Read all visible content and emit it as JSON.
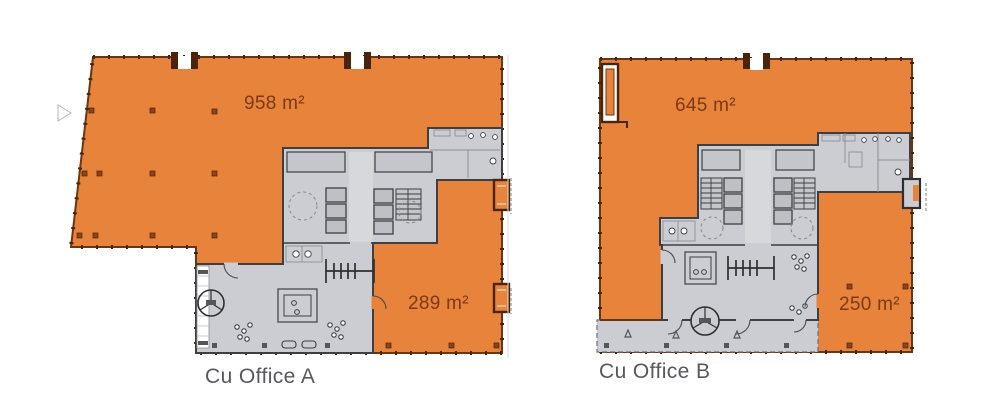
{
  "figure": {
    "type": "floor-plans",
    "description": "Two office floor plans with highlighted leasable areas"
  },
  "colors": {
    "background": "#FFFFFF",
    "office": "#E8833B",
    "office_wall": "#6B3511",
    "tick": "#4A2408",
    "column": "#8A4518",
    "core_fill": "#CCCDD2",
    "core_mid": "#C5C6CB",
    "core_light": "#D7D8DC",
    "core_box": "#BFC0C5",
    "core_wall": "#3E3F42",
    "line_light": "#8E8F94",
    "area_text": "#7B3A12",
    "label_text": "#57585B"
  },
  "plans": [
    {
      "label": "Cu Office A",
      "areas": [
        {
          "name": "north office area",
          "value": "958 m²"
        },
        {
          "name": "south office area",
          "value": "289 m²"
        }
      ]
    },
    {
      "label": "Cu Office B",
      "areas": [
        {
          "name": "north office area",
          "value": "645 m²"
        },
        {
          "name": "south office area",
          "value": "250 m²"
        }
      ]
    }
  ]
}
